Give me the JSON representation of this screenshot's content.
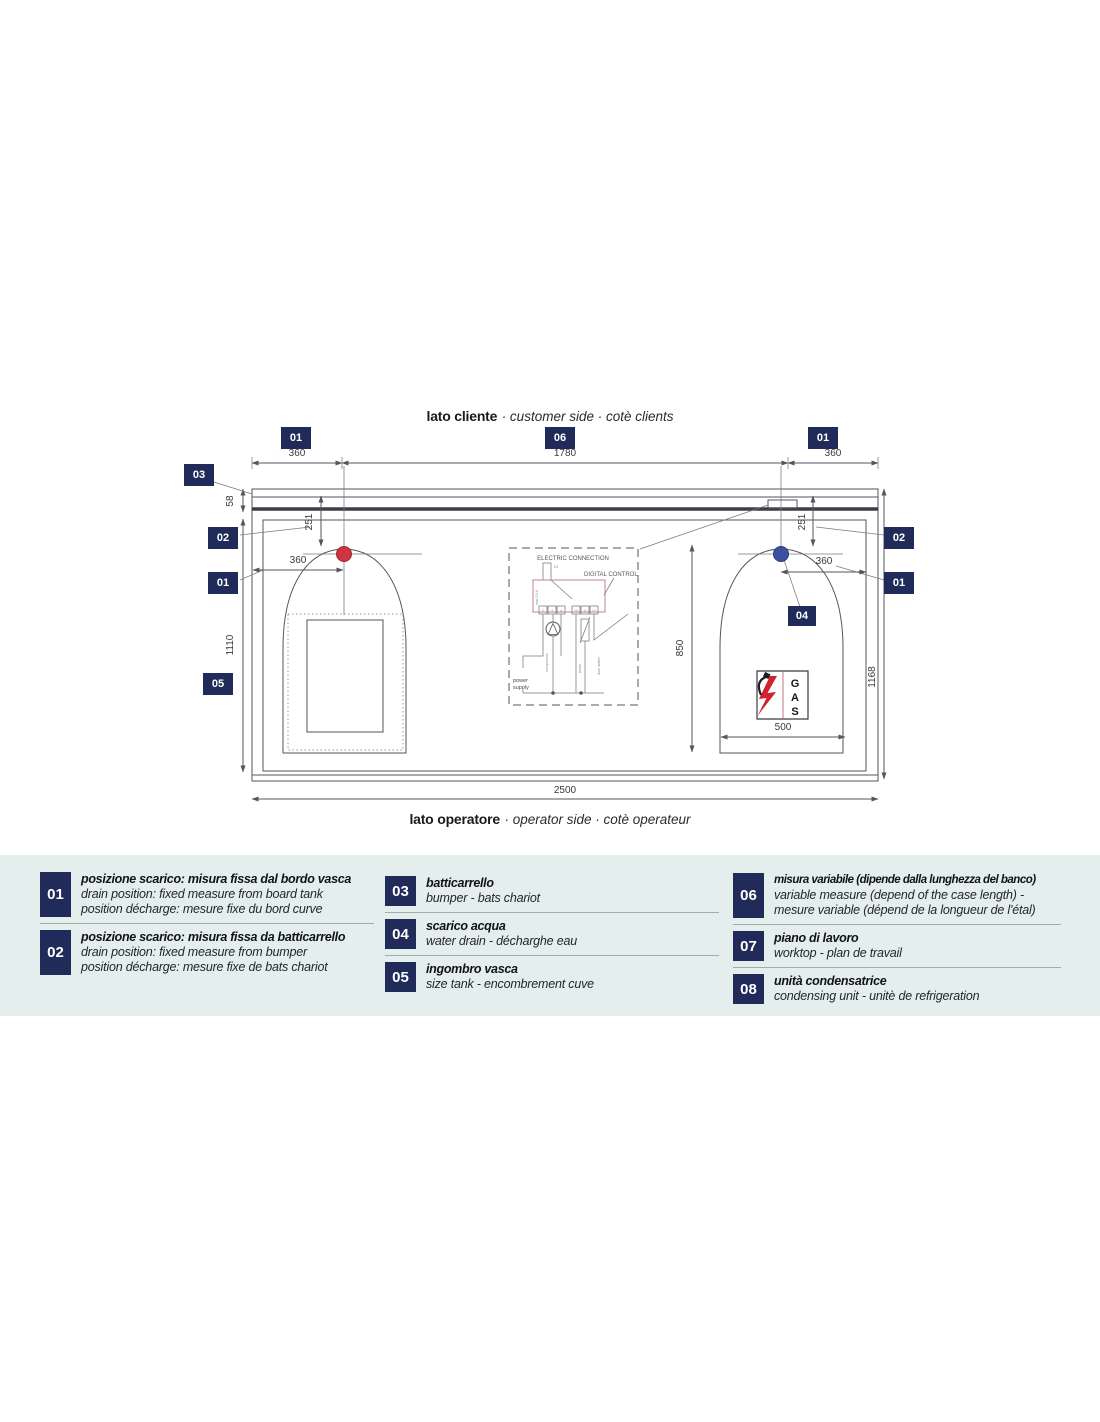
{
  "colors": {
    "badge_navy": "#202b5a",
    "band_bg": "#e4eeec",
    "drain_red": "#cf3440",
    "drain_blue": "#3c50a0",
    "control_pink": "#c9808d",
    "lightning_red": "#d0232e",
    "line_gray": "#55555c"
  },
  "titles": {
    "customer_bold": "lato cliente",
    "customer_rest": "· customer side · cotè clients",
    "operator_bold": "lato operatore",
    "operator_rest": "· operator side · cotè operateur"
  },
  "markers": {
    "m01a": "01",
    "m06": "06",
    "m01b": "01",
    "m03": "03",
    "m02l": "02",
    "m01l": "01",
    "m05": "05",
    "m02r": "02",
    "m01r": "01",
    "m04": "04"
  },
  "dims": {
    "top_left": "360",
    "top_mid": "1780",
    "top_right": "360",
    "band_height": "58",
    "offset_left": "251",
    "offset_right": "251",
    "drain_left": "360",
    "drain_right": "360",
    "depth_left": "1110",
    "depth_mid": "850",
    "depth_right": "1168",
    "unit_width": "500",
    "total_width": "2500"
  },
  "electric": {
    "title": "ELECTRIC CONNECTION",
    "digital": "DIGITAL CONTROL",
    "relay": "K1",
    "rating": "max 10 A",
    "terminals_left": [
      "2",
      "3",
      "4"
    ],
    "terminals_right": [
      "10",
      "11",
      "12"
    ],
    "power_1": "power",
    "power_2": "supply",
    "wire_1": "compressor",
    "wire_2": "probe",
    "wire_3": "door switch",
    "gas_1": "G",
    "gas_2": "A",
    "gas_3": "S"
  },
  "legend": {
    "col1": [
      {
        "num": "01",
        "lines": [
          "posizione scarico: misura fissa dal bordo vasca",
          "drain position: fixed measure from board tank",
          "position décharge: mesure fixe du bord curve"
        ]
      },
      {
        "num": "02",
        "lines": [
          "posizione scarico: misura fissa da batticarrello",
          "drain position: fixed measure from bumper",
          "position décharge: mesure fixe de bats chariot"
        ]
      }
    ],
    "col2": [
      {
        "num": "03",
        "lines": [
          "batticarrello",
          "bumper - bats chariot"
        ]
      },
      {
        "num": "04",
        "lines": [
          "scarico acqua",
          "water drain - décharghe eau"
        ]
      },
      {
        "num": "05",
        "lines": [
          "ingombro vasca",
          "size tank  - encombrement cuve"
        ]
      }
    ],
    "col3": [
      {
        "num": "06",
        "lines": [
          "misura variabile (dipende dalla lunghezza del banco)",
          "variable measure (depend of the case length) -",
          "mesure variable (dépend de la longueur de l'étal)"
        ]
      },
      {
        "num": "07",
        "lines": [
          "piano di lavoro",
          "worktop - plan de travail"
        ]
      },
      {
        "num": "08",
        "lines": [
          "unità condensatrice",
          "condensing unit - unitè de refrigeration"
        ]
      }
    ]
  }
}
